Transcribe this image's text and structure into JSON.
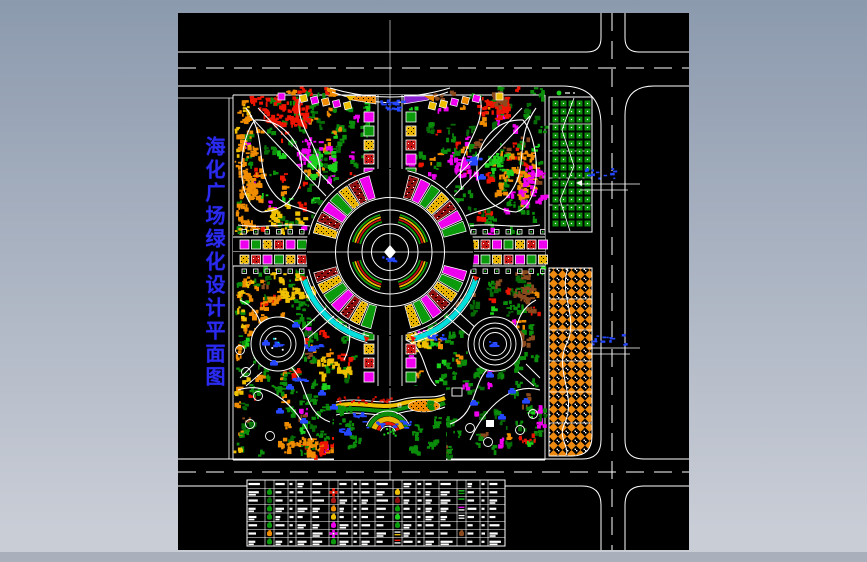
{
  "title": {
    "text": "海化广场绿化设计平面图",
    "color": "#2b2bf0"
  },
  "frame": {
    "bg_top": "#8c9aae",
    "bg_bottom": "#c9cdd6",
    "footer_bar": "#aab0bb",
    "canvas_bg": "#000000",
    "line_color": "#ffffff"
  },
  "palette": {
    "green": "#0b8d0b",
    "green_dark": "#066a06",
    "green_bright": "#1dd11d",
    "red": "#ee1500",
    "orange": "#f08c00",
    "yellow": "#eec000",
    "magenta": "#ee00ee",
    "cyan": "#00dede",
    "blue": "#2547ff",
    "brown": "#8a4a1e",
    "dark_red": "#8d0f0f",
    "purple": "#8820d0",
    "white": "#ffffff"
  },
  "plaza": {
    "wedge_cycle": [
      "magenta",
      "green",
      "yellow_dot",
      "red_hatch"
    ],
    "ring_arc_colors": [
      "#0b9a0b",
      "#eec000",
      "#d01010",
      "#0b9a0b"
    ]
  },
  "planters": {
    "cycle": [
      "magenta",
      "green",
      "yellow_dot",
      "red_dot"
    ]
  },
  "parking": {
    "north_type": "grass-grid-lot",
    "south_type": "paved-checker-lot"
  },
  "annotations": {
    "color": "#2547ff"
  },
  "legend_table": {
    "x": 247,
    "y": 480,
    "width": 258,
    "height": 66,
    "rows": 8,
    "groups": 4,
    "group_col_widths": [
      18,
      9,
      14,
      8,
      15
    ],
    "symbols": [
      {
        "g": 0,
        "r": 1,
        "kind": "tree",
        "color": "#0b9a0b"
      },
      {
        "g": 0,
        "r": 2,
        "kind": "tree",
        "color": "#066a06"
      },
      {
        "g": 0,
        "r": 3,
        "kind": "tree",
        "color": "#0b9a0b"
      },
      {
        "g": 0,
        "r": 4,
        "kind": "tree",
        "color": "#0b9a0b"
      },
      {
        "g": 0,
        "r": 5,
        "kind": "tree",
        "color": "#0b9a0b"
      },
      {
        "g": 0,
        "r": 6,
        "kind": "tree",
        "color": "#f08c00"
      },
      {
        "g": 0,
        "r": 7,
        "kind": "tree",
        "color": "#0b9a0b"
      },
      {
        "g": 1,
        "r": 1,
        "kind": "flower",
        "color": "#ee1500"
      },
      {
        "g": 1,
        "r": 2,
        "kind": "tree",
        "color": "#aa1717"
      },
      {
        "g": 1,
        "r": 3,
        "kind": "tree",
        "color": "#f08c00"
      },
      {
        "g": 1,
        "r": 4,
        "kind": "tree",
        "color": "#eec000"
      },
      {
        "g": 1,
        "r": 5,
        "kind": "tree",
        "color": "#ee00ee"
      },
      {
        "g": 1,
        "r": 6,
        "kind": "flower",
        "color": "#ee00ee"
      },
      {
        "g": 1,
        "r": 7,
        "kind": "tree",
        "color": "#0b9a0b"
      },
      {
        "g": 2,
        "r": 1,
        "kind": "tree",
        "color": "#eec000"
      },
      {
        "g": 2,
        "r": 2,
        "kind": "tree",
        "color": "#8d0f0f"
      },
      {
        "g": 2,
        "r": 3,
        "kind": "tree",
        "color": "#0b9a0b"
      },
      {
        "g": 2,
        "r": 4,
        "kind": "tree",
        "color": "#1dd11d"
      },
      {
        "g": 2,
        "r": 5,
        "kind": "tree",
        "color": "#0b9a0b"
      },
      {
        "g": 2,
        "r": 6,
        "kind": "lines",
        "colors": [
          "#ffffff",
          "#eec000"
        ]
      },
      {
        "g": 2,
        "r": 7,
        "kind": "lines",
        "colors": [
          "#ee1500",
          "#ffffff"
        ]
      },
      {
        "g": 3,
        "r": 1,
        "kind": "lines",
        "colors": [
          "#1dd11d",
          "#0b9a0b"
        ]
      },
      {
        "g": 3,
        "r": 2,
        "kind": "lines",
        "colors": [
          "#1dd11d"
        ]
      },
      {
        "g": 3,
        "r": 3,
        "kind": "lines",
        "colors": [
          "#ee00ee",
          "#ffffff"
        ]
      },
      {
        "g": 3,
        "r": 4,
        "kind": "lines",
        "colors": [
          "#ffffff",
          "#ffffff"
        ]
      },
      {
        "g": 3,
        "r": 6,
        "kind": "tree",
        "color": "#8a4a1e"
      }
    ]
  }
}
